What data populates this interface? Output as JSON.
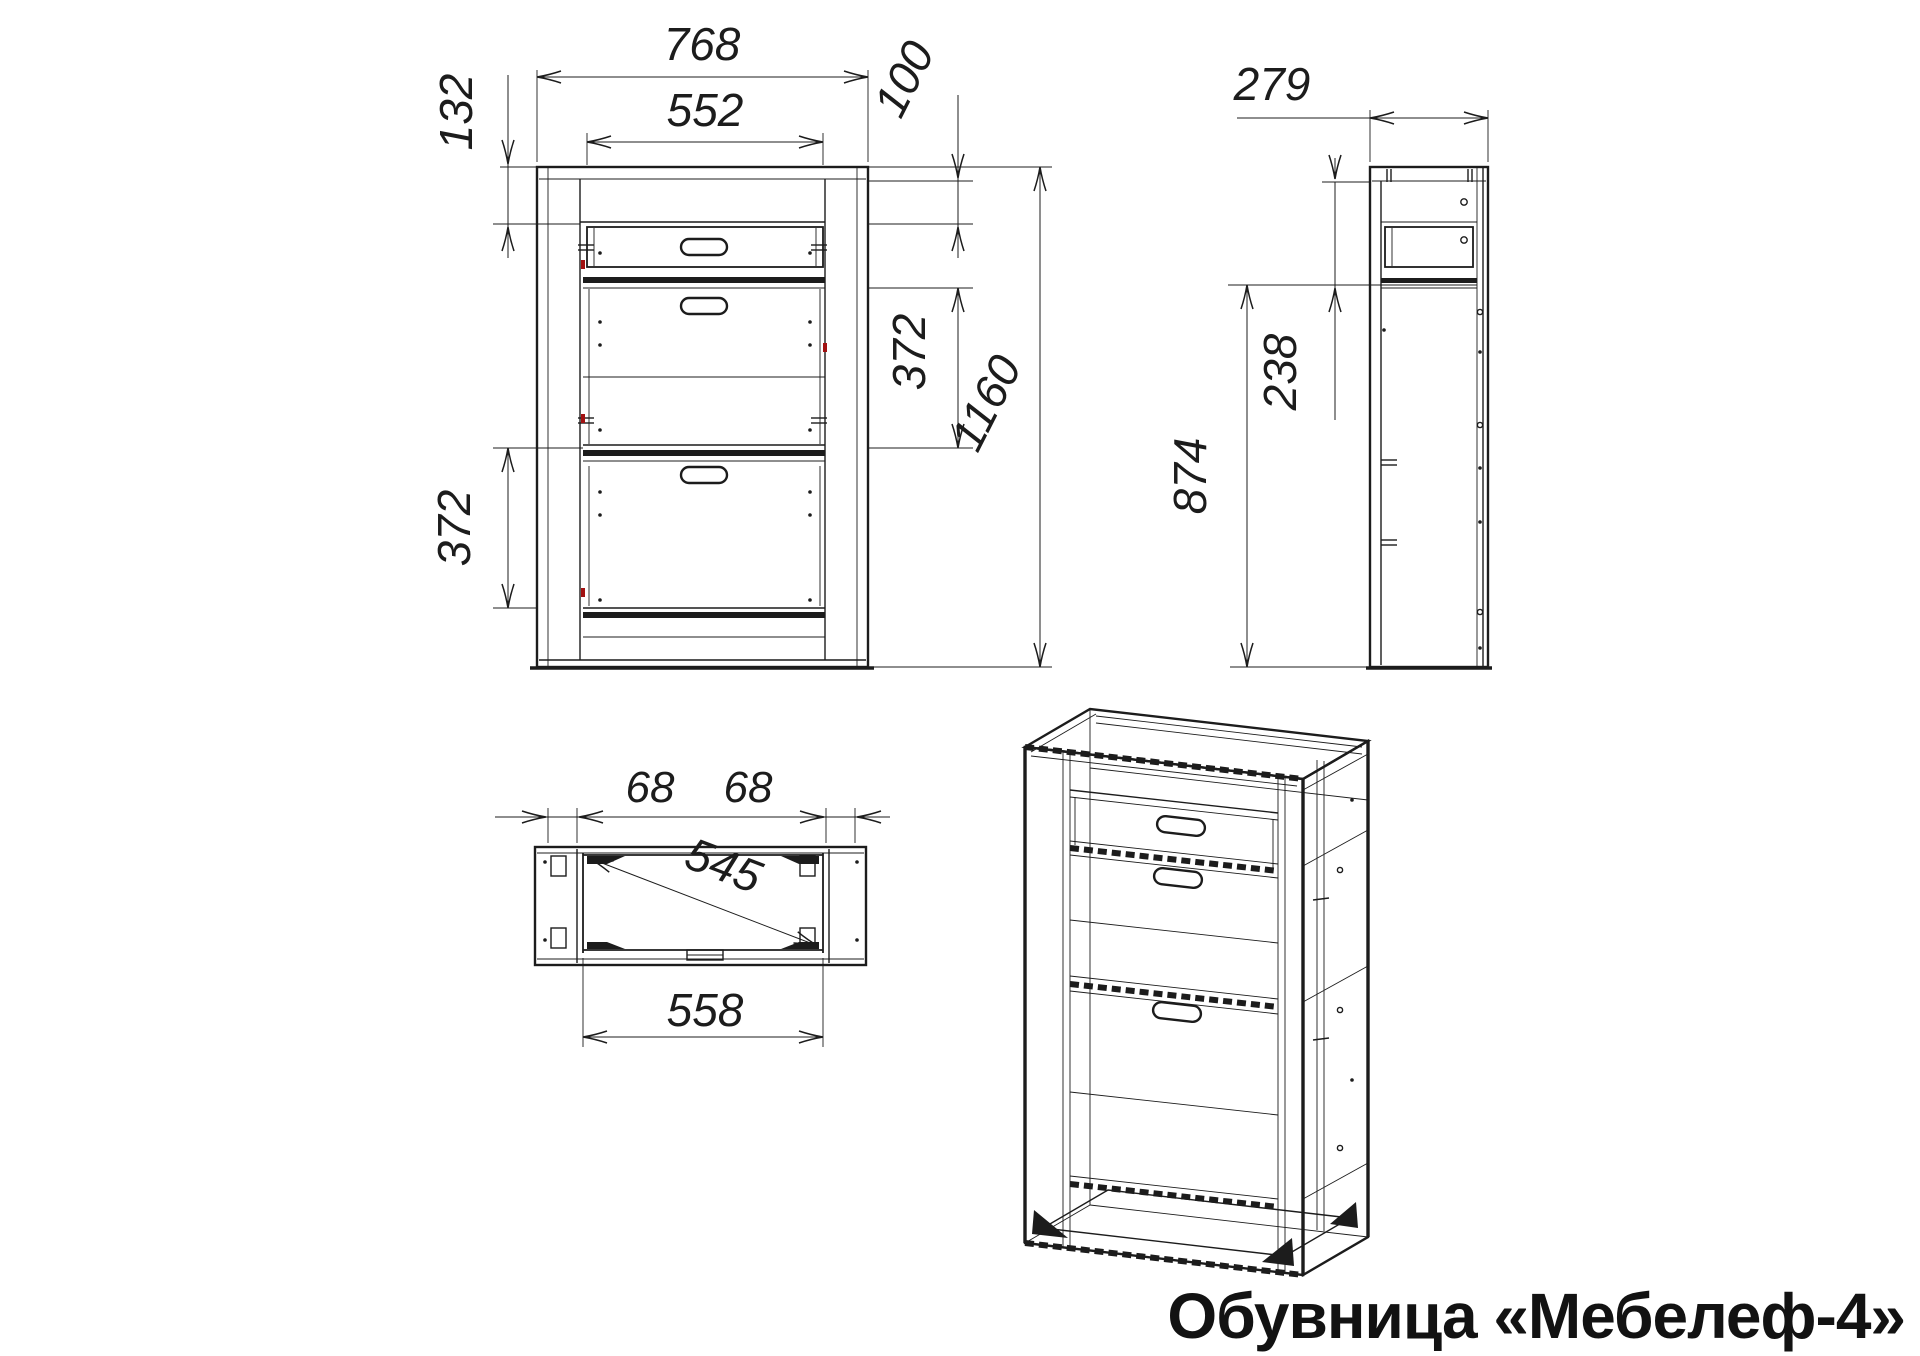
{
  "title": "Обувница «Мебелеф-4»",
  "drawing": {
    "line_color": "#1c1c1c",
    "accent_red": "#a21111",
    "background": "#ffffff"
  },
  "views": {
    "front": {
      "dims": {
        "overall_width": "768",
        "inner_width": "552",
        "top_rail_height": "132",
        "drawer_opening_height": "100",
        "upper_flap_height": "372",
        "overall_height": "1160",
        "lower_flap_height": "372"
      }
    },
    "side": {
      "dims": {
        "overall_depth": "279",
        "top_section_height": "238",
        "lower_section_height": "874"
      }
    },
    "top": {
      "dims": {
        "left_panel_width": "68",
        "right_panel_width": "68",
        "inner_diagonal": "545",
        "inner_width": "558"
      }
    }
  }
}
